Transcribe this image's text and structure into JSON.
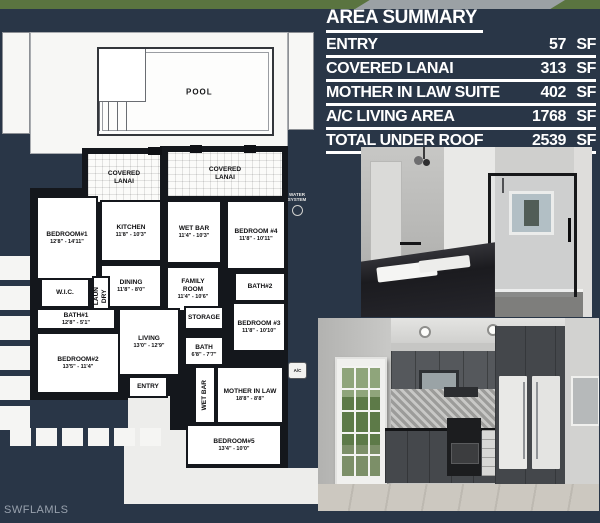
{
  "colors": {
    "background": "#293647",
    "plan_wall": "#14171c",
    "table_text": "#ffffff",
    "grass": "#5a7440",
    "driveway": "#9ba1a5"
  },
  "area_summary": {
    "title": "AREA SUMMARY",
    "rows": [
      {
        "label": "ENTRY",
        "value": "57",
        "unit": "SF"
      },
      {
        "label": "COVERED LANAI",
        "value": "313",
        "unit": "SF"
      },
      {
        "label": "MOTHER IN LAW SUITE",
        "value": "402",
        "unit": "SF"
      },
      {
        "label": "A/C LIVING AREA",
        "value": "1768",
        "unit": "SF"
      },
      {
        "label": "TOTAL UNDER ROOF",
        "value": "2539",
        "unit": "SF"
      }
    ]
  },
  "floor_plan": {
    "pool": {
      "label": "POOL"
    },
    "water_system": {
      "label": "WATER\nSYSTEM"
    },
    "ac_badge": {
      "label": "A/C"
    },
    "rooms": [
      {
        "id": "covered-lanai-left",
        "label": "COVERED\nLANAI",
        "dims": ""
      },
      {
        "id": "covered-lanai-right",
        "label": "COVERED\nLANAI",
        "dims": ""
      },
      {
        "id": "bedroom-1",
        "label": "BEDROOM#1",
        "dims": "12'8\" - 14'11\""
      },
      {
        "id": "kitchen",
        "label": "KITCHEN",
        "dims": "11'8\" - 10'3\""
      },
      {
        "id": "wet-bar-top",
        "label": "WET BAR",
        "dims": "11'4\" - 10'3\""
      },
      {
        "id": "bedroom-4",
        "label": "BEDROOM #4",
        "dims": "11'8\" - 10'11\""
      },
      {
        "id": "dining",
        "label": "DINING",
        "dims": "11'8\" - 8'0\""
      },
      {
        "id": "family-room",
        "label": "FAMILY\nROOM",
        "dims": "11'4\" - 10'6\""
      },
      {
        "id": "bath-2",
        "label": "BATH#2",
        "dims": ""
      },
      {
        "id": "wic",
        "label": "W.I.C.",
        "dims": ""
      },
      {
        "id": "laundry",
        "label": "LAUN\nDRY",
        "dims": ""
      },
      {
        "id": "bath-1",
        "label": "BATH#1",
        "dims": "12'8\" - 5'1\""
      },
      {
        "id": "storage",
        "label": "STORAGE",
        "dims": ""
      },
      {
        "id": "bedroom-3",
        "label": "BEDROOM #3",
        "dims": "11'8\" - 10'10\""
      },
      {
        "id": "bath",
        "label": "BATH",
        "dims": "6'8\" - 7'7\""
      },
      {
        "id": "living",
        "label": "LIVING",
        "dims": "13'0\" - 12'9\""
      },
      {
        "id": "bedroom-2",
        "label": "BEDROOM#2",
        "dims": "13'5\" - 11'4\""
      },
      {
        "id": "entry",
        "label": "ENTRY",
        "dims": ""
      },
      {
        "id": "wet-bar-vertical",
        "label": "WET BAR",
        "dims": ""
      },
      {
        "id": "mother-in-law",
        "label": "MOTHER IN LAW",
        "dims": "18'8\" - 8'8\""
      },
      {
        "id": "bedroom-5",
        "label": "BEDROOM#5",
        "dims": "13'4\" - 10'0\""
      }
    ]
  },
  "photos": {
    "bathroom": {
      "name": "bathroom-render"
    },
    "kitchen": {
      "name": "kitchen-render"
    }
  },
  "watermark": "SWFLAMLS"
}
